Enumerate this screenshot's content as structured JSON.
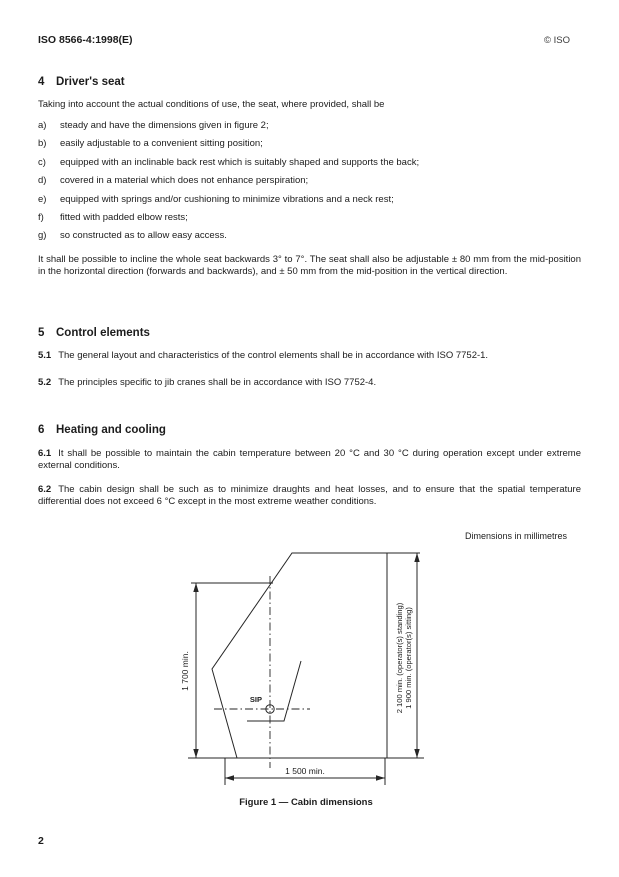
{
  "header": {
    "left": "ISO 8566-4:1998(E)",
    "right": "© ISO"
  },
  "sections": {
    "s4": {
      "number": "4",
      "title": "Driver's seat",
      "intro": "Taking into account the actual conditions of use, the seat, where provided, shall be",
      "items": [
        {
          "label": "a)",
          "text": "steady and have the dimensions given in figure 2;"
        },
        {
          "label": "b)",
          "text": "easily adjustable to a convenient sitting position;"
        },
        {
          "label": "c)",
          "text": "equipped with an inclinable back rest which is suitably shaped and supports the back;"
        },
        {
          "label": "d)",
          "text": "covered in a material which does not enhance perspiration;"
        },
        {
          "label": "e)",
          "text": "equipped with springs and/or cushioning to minimize vibrations and a neck rest;"
        },
        {
          "label": "f)",
          "text": "fitted with padded elbow rests;"
        },
        {
          "label": "g)",
          "text": "so constructed as to allow easy access."
        }
      ],
      "paragraph": "It shall be possible to incline the whole seat backwards 3° to 7°. The seat shall also be adjustable ± 80 mm from the mid-position in the horizontal direction (forwards and backwards), and ± 50 mm from the mid-position in the vertical direction."
    },
    "s5": {
      "number": "5",
      "title": "Control elements",
      "clauses": [
        {
          "number": "5.1",
          "text": "The general layout and characteristics of the control elements shall be in accordance with ISO 7752-1."
        },
        {
          "number": "5.2",
          "text": "The principles specific to jib cranes shall be in accordance with ISO 7752-4."
        }
      ]
    },
    "s6": {
      "number": "6",
      "title": "Heating and cooling",
      "clauses": [
        {
          "number": "6.1",
          "text": "It shall be possible to maintain the cabin temperature between 20 °C and 30 °C during operation except under extreme external conditions."
        },
        {
          "number": "6.2",
          "text": "The cabin design shall be such as to minimize draughts and heat losses, and to ensure that the spatial temperature differential does not exceed 6 °C except in the most extreme weather conditions."
        }
      ]
    }
  },
  "figure": {
    "note": "Dimensions in millimetres",
    "caption": "Figure 1 — Cabin dimensions",
    "dim_left": "1 700 min.",
    "dim_right_line1": "2 100 min. (operator(s) standing)",
    "dim_right_line2": "1 900 min. (operator(s) sitting)",
    "dim_bottom": "1 500 min.",
    "sip": "SIP"
  },
  "page_number": "2"
}
